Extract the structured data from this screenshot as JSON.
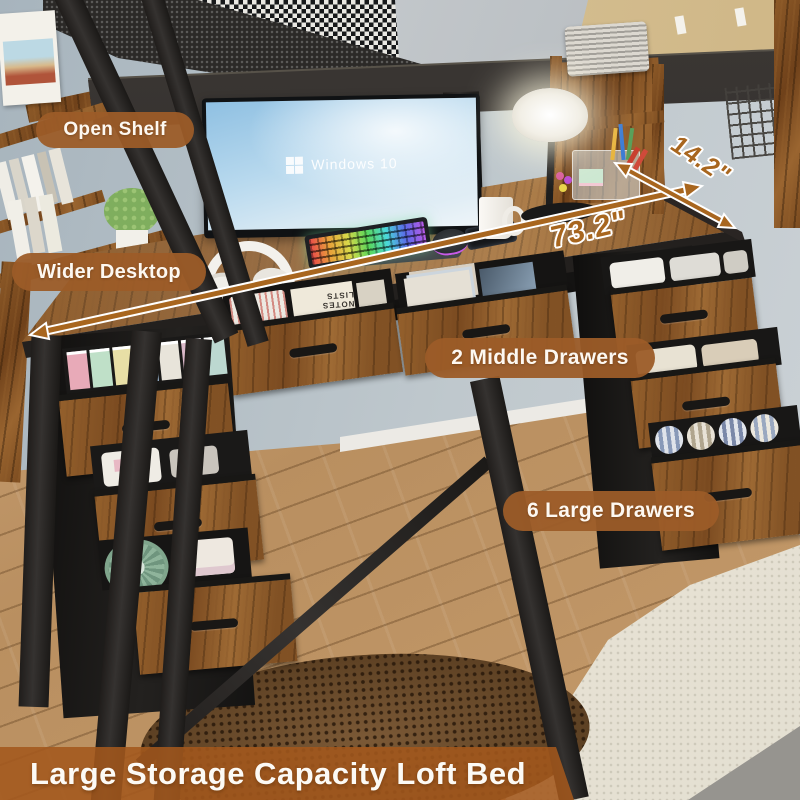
{
  "callouts": [
    {
      "id": "open-shelf",
      "label": "Open Shelf"
    },
    {
      "id": "wider-desktop",
      "label": "Wider Desktop"
    },
    {
      "id": "middle-drawers",
      "label": "2 Middle Drawers"
    },
    {
      "id": "large-drawers",
      "label": "6 Large Drawers"
    }
  ],
  "dimensions": {
    "width": {
      "label": "73.2\""
    },
    "depth": {
      "label": "14.2\""
    }
  },
  "banner": {
    "label": "Large Storage Capacity Loft Bed"
  },
  "monitor": {
    "label": "Windows 10"
  },
  "notebook": {
    "label": "NOTES LISTS"
  },
  "colors": {
    "badge": "#9c5c28",
    "banner": "#a35a1c",
    "dimension_text": "#a8661f",
    "desk_wood": "#8a5628",
    "metal_frame": "#2b2826",
    "wall": "#b4bfc6",
    "floor": "#c19a6b"
  }
}
